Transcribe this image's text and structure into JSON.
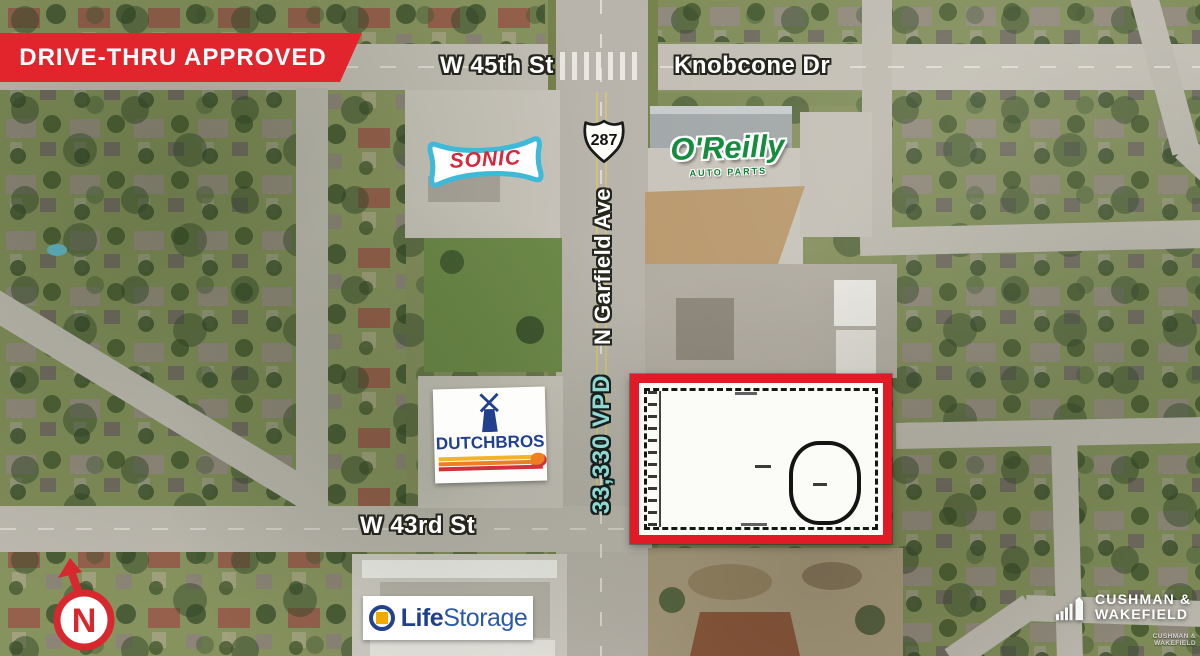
{
  "banner": {
    "label": "DRIVE-THRU APPROVED",
    "bg_color": "#E2242D",
    "text_color": "#FFFFFF"
  },
  "streets": {
    "w45th": "W 45th St",
    "knobcone": "Knobcone Dr",
    "garfield": "N Garfield Ave",
    "w43rd": "W 43rd St"
  },
  "highway_shield": {
    "number": "287"
  },
  "traffic_count": {
    "label": "33,330 VPD",
    "color": "#8FD8D2"
  },
  "tenants": {
    "sonic": {
      "name": "SONIC",
      "text_color": "#D5283C",
      "border_color": "#3FB9D8"
    },
    "oreilly": {
      "name": "O'Reilly",
      "subtext": "AUTO PARTS",
      "color": "#168C3E"
    },
    "dutch_bros": {
      "word1": "DUTCH",
      "word2": "BROS",
      "color": "#21418F"
    },
    "life_storage": {
      "word1": "Life",
      "word2": "Storage",
      "color": "#1F3F8C"
    }
  },
  "site": {
    "outline_color": "#E01B26"
  },
  "compass": {
    "label": "N",
    "color": "#D7282F"
  },
  "branding": {
    "line1": "CUSHMAN &",
    "line2": "WAKEFIELD",
    "watermark_line1": "CUSHMAN &",
    "watermark_line2": "WAKEFIELD"
  }
}
